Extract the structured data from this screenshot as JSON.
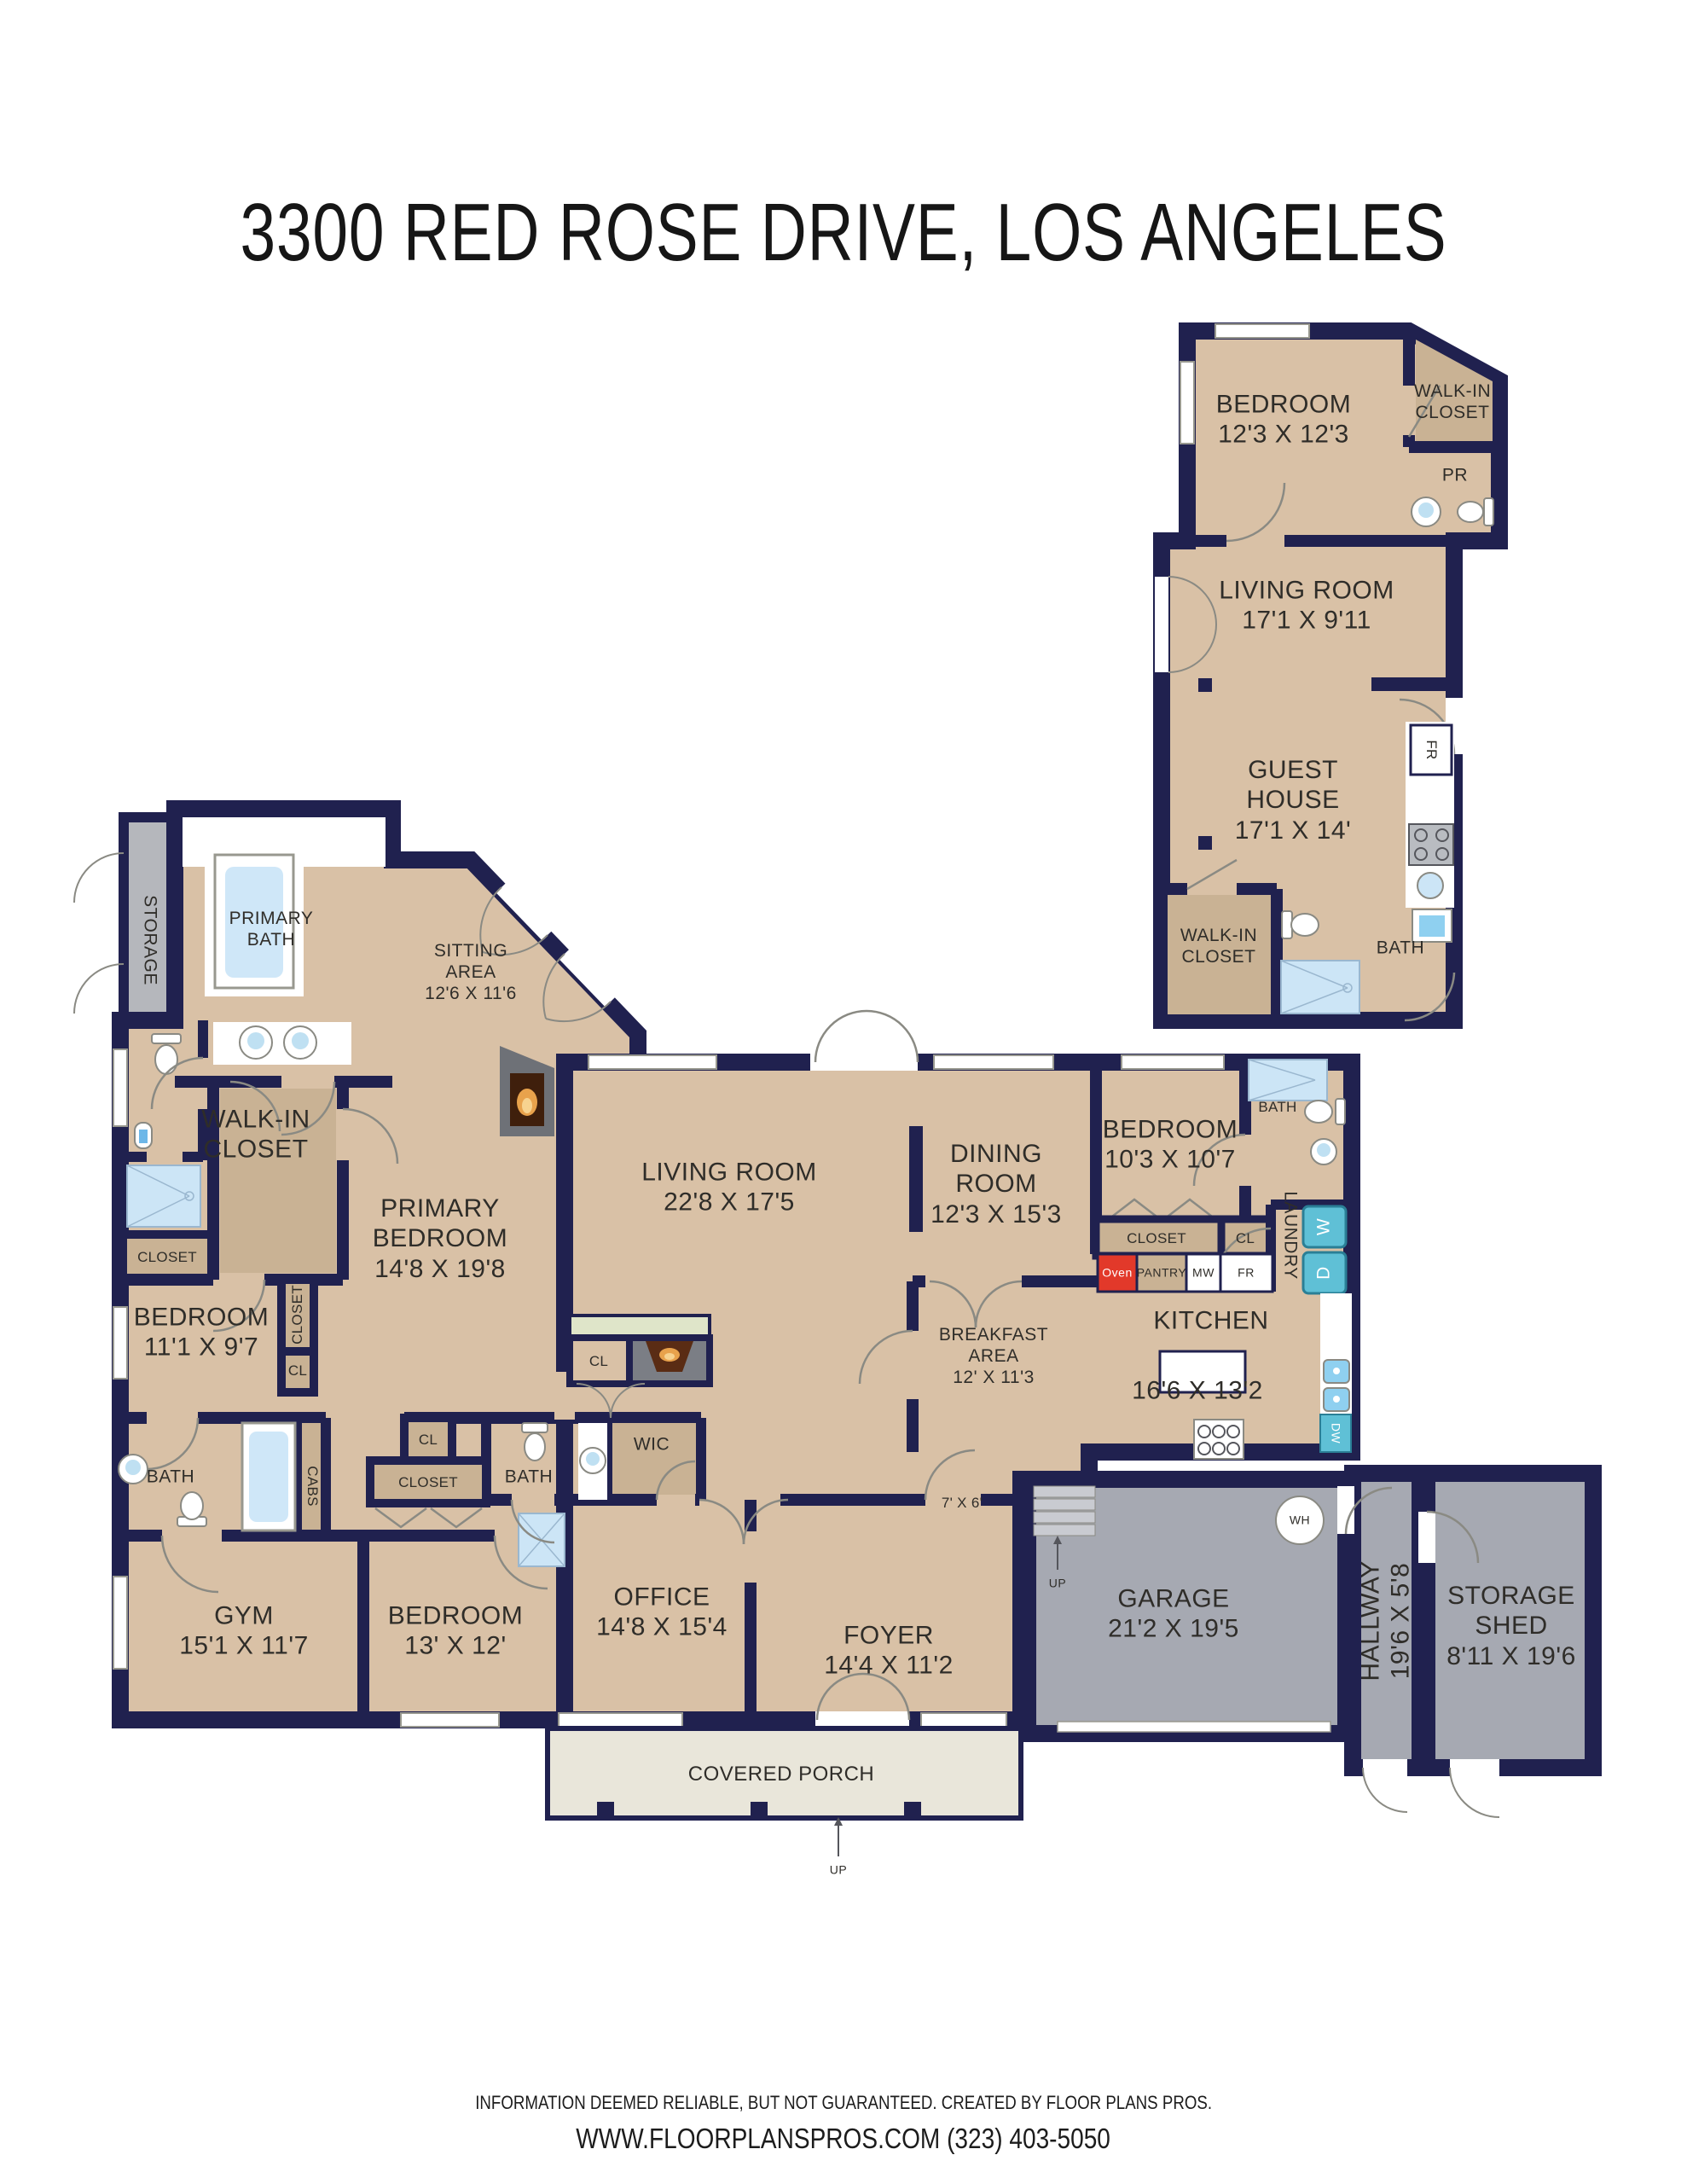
{
  "title": "3300 RED ROSE DRIVE, LOS ANGELES",
  "colors": {
    "wall": "#20214f",
    "floor": "#d9c1a6",
    "closet_floor": "#c9b294",
    "garage_gray": "#a6a9b2",
    "storage_gray": "#b5b7bc",
    "porch": "#e9e6da",
    "shower_blue": "#cce5f6",
    "appliance_teal": "#5fc0d6",
    "oven_red": "#e2392a",
    "counter_green": "#dfe5c9",
    "door_gray": "#8a8a83"
  },
  "guest_house": {
    "bedroom": "BEDROOM\n12'3 X 12'3",
    "walk_in_closet": "WALK-IN\nCLOSET",
    "powder_room": "PR",
    "living_room": "LIVING ROOM\n17'1 X 9'11",
    "guest_house": "GUEST\nHOUSE\n17'1 X 14'",
    "walk_in_closet_2": "WALK-IN\nCLOSET",
    "bath": "BATH",
    "fridge": "FR"
  },
  "main_house": {
    "storage": "STORAGE",
    "primary_bath": "PRIMARY\nBATH",
    "sitting_area": "SITTING\nAREA\n12'6 X 11'6",
    "walk_in_closet": "WALK-IN\nCLOSET",
    "primary_bedroom": "PRIMARY\nBEDROOM\n14'8 X 19'8",
    "closet_left": "CLOSET",
    "bedroom_2": "BEDROOM\n11'1 X 9'7",
    "closet_vertical": "CLOSET",
    "cl_a": "CL",
    "living_room": "LIVING ROOM\n22'8 X 17'5",
    "cl_living": "CL",
    "dining_room": "DINING\nROOM\n12'3 X 15'3",
    "bedroom_3": "BEDROOM\n10'3 X 10'7",
    "bath_ensuite": "BATH",
    "laundry": "LAUNDRY",
    "closet_b": "CLOSET",
    "cl_b": "CL",
    "oven": "Oven",
    "pantry": "PANTRY",
    "microwave": "MW",
    "fridge": "FR",
    "washer": "W",
    "dryer": "D",
    "dishwasher": "DW",
    "kitchen": "KITCHEN",
    "kitchen_dims": "16'6 X 13'2",
    "breakfast_area": "BREAKFAST\nAREA\n12' X 11'3",
    "nook": "7' X 6'",
    "up_stairs": "UP",
    "bath_1": "BATH",
    "cabs": "CABS",
    "cl_c": "CL",
    "closet_c": "CLOSET",
    "bath_2": "BATH",
    "wic_2": "WIC",
    "gym": "GYM\n15'1 X 11'7",
    "bedroom_4": "BEDROOM\n13' X 12'",
    "office": "OFFICE\n14'8 X 15'4",
    "foyer": "FOYER\n14'4 X 11'2",
    "garage": "GARAGE\n21'2 X 19'5",
    "water_heater": "WH",
    "hallway": "HALLWAY\n19'6 X 5'8",
    "storage_shed": "STORAGE\nSHED\n8'11 X 19'6",
    "covered_porch": "COVERED PORCH",
    "up_porch": "UP"
  },
  "footer": {
    "disclaimer": "INFORMATION DEEMED RELIABLE, BUT NOT GUARANTEED. CREATED BY FLOOR PLANS PROS.",
    "contact": "WWW.FLOORPLANSPROS.COM  (323) 403-5050"
  }
}
